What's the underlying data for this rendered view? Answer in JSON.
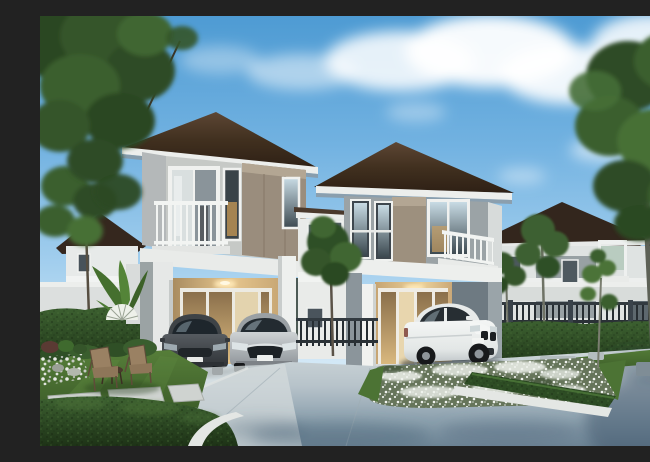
{
  "image": {
    "title": "Architectural rendering of two modern two-storey houses with cars, gardens and driveway",
    "description": "Photorealistic daytime rendering: two modern two-storey homes with dark brown hip roofs, grey and taupe upper walls and white trim. The left house has a carport with a dark grey hatchback and a silver sedan; a white SUV is parked at the right house entrance. Landscaped hedges, a white flower bed with trimmed border, patio chairs, stepping stones and tall trees surround a blue-grey concrete driveway under a blue sky with fluffy clouds.",
    "objects": [
      "sky",
      "clouds",
      "left-tree",
      "right-tree",
      "background-houses",
      "perimeter-wall",
      "metal-fence",
      "left-house",
      "right-house",
      "carport",
      "balconies",
      "dark-grey-hatchback",
      "silver-sedan",
      "white-suv",
      "hedges",
      "flower-bed",
      "lawns",
      "patio-chairs",
      "stepping-stones",
      "driveway",
      "banana-plants",
      "fan-palm",
      "sapling"
    ]
  },
  "palette": {
    "sky_top": "#4e9bd3",
    "sky_horizon": "#e9f3fa",
    "cloud_white": "#ffffff",
    "roof_brown": "#3a2b20",
    "trim_white": "#eceeec",
    "wall_white": "#e7e9e8",
    "wall_gray": "#9ba3a6",
    "wall_taupe": "#9a8d7d",
    "wall_shade_gray": "#b4b8b9",
    "warm_light": "#e6c68e",
    "glass_dark": "#39424a",
    "hedge_green": "#2d4c24",
    "lawn_green": "#4f7734",
    "tree_green": "#3a5e2e",
    "trunk_gray": "#5d6156",
    "drive_light": "#ccd5d8",
    "drive_shadow": "#6d8495",
    "curb_white": "#e4e7e4",
    "fence_dark": "#2a3136",
    "car_dark_gray": "#43484d",
    "car_silver": "#b4b8bb",
    "car_white": "#eef0ef",
    "flower_white": "#f2f4f0",
    "wicker_brown": "#8e7659"
  }
}
